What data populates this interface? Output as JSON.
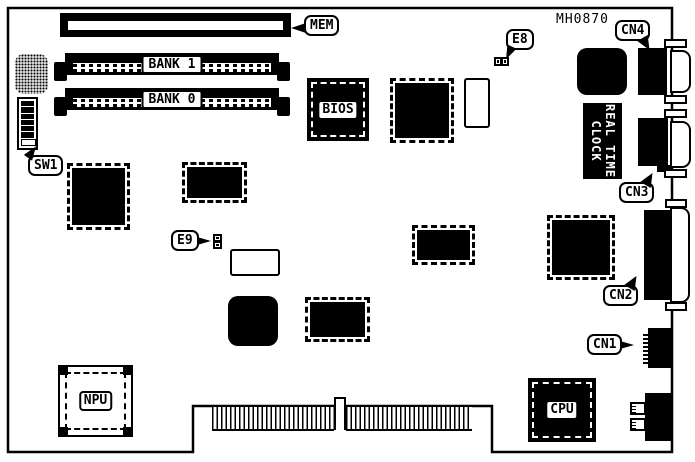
{
  "part_number": "MH0870",
  "colors": {
    "ink": "#000000",
    "paper": "#ffffff"
  },
  "callouts": {
    "mem": "MEM",
    "sw1": "SW1",
    "e8": "E8",
    "e9": "E9",
    "cn1": "CN1",
    "cn2": "CN2",
    "cn3": "CN3",
    "cn4": "CN4"
  },
  "slots": {
    "bank1": "BANK 1",
    "bank0": "BANK 0"
  },
  "chips": {
    "bios": "BIOS",
    "npu": "NPU",
    "cpu": "CPU"
  },
  "rtc": {
    "line1": "REAL TIME",
    "line2": "CLOCK"
  }
}
